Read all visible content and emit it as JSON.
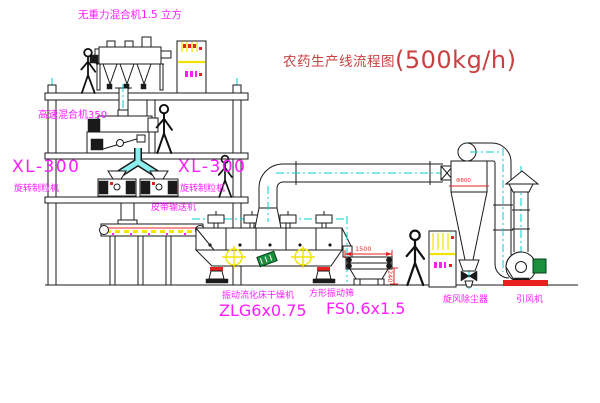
{
  "title": {
    "text": "农药生产线流程图",
    "capacity": "(500kg/h)"
  },
  "equipment": {
    "gravity_mixer": {
      "label": "无重力混合机1.5 立方"
    },
    "high_speed_mixer": {
      "label": "高速混合机350"
    },
    "granulator_left": {
      "model": "XL-300",
      "name": "旋转制粒机"
    },
    "granulator_right": {
      "model": "XL-300",
      "name": "旋转制粒机"
    },
    "belt_conveyor": {
      "name": "皮带输送机"
    },
    "dryer": {
      "name": "振动流化床干燥机",
      "model": "ZLG6x0.75"
    },
    "sieve": {
      "name": "方形振动筛",
      "model": "FS0.6x1.5",
      "dim_length": "1500",
      "dim_base_height": "240"
    },
    "cyclone": {
      "name": "旋风除尘器",
      "dim_diameter": "Φ800"
    },
    "fan": {
      "name": "引风机"
    }
  },
  "colors": {
    "line": "#1a1a1a",
    "centerline": "#00d2d2",
    "label_magenta": "#ff1cff",
    "title_red": "#c84040",
    "accent_red": "#e82020",
    "highlight_yellow": "#f5e400",
    "motor_green": "#1b8f3c",
    "pipe_cyan": "#8deef0"
  }
}
